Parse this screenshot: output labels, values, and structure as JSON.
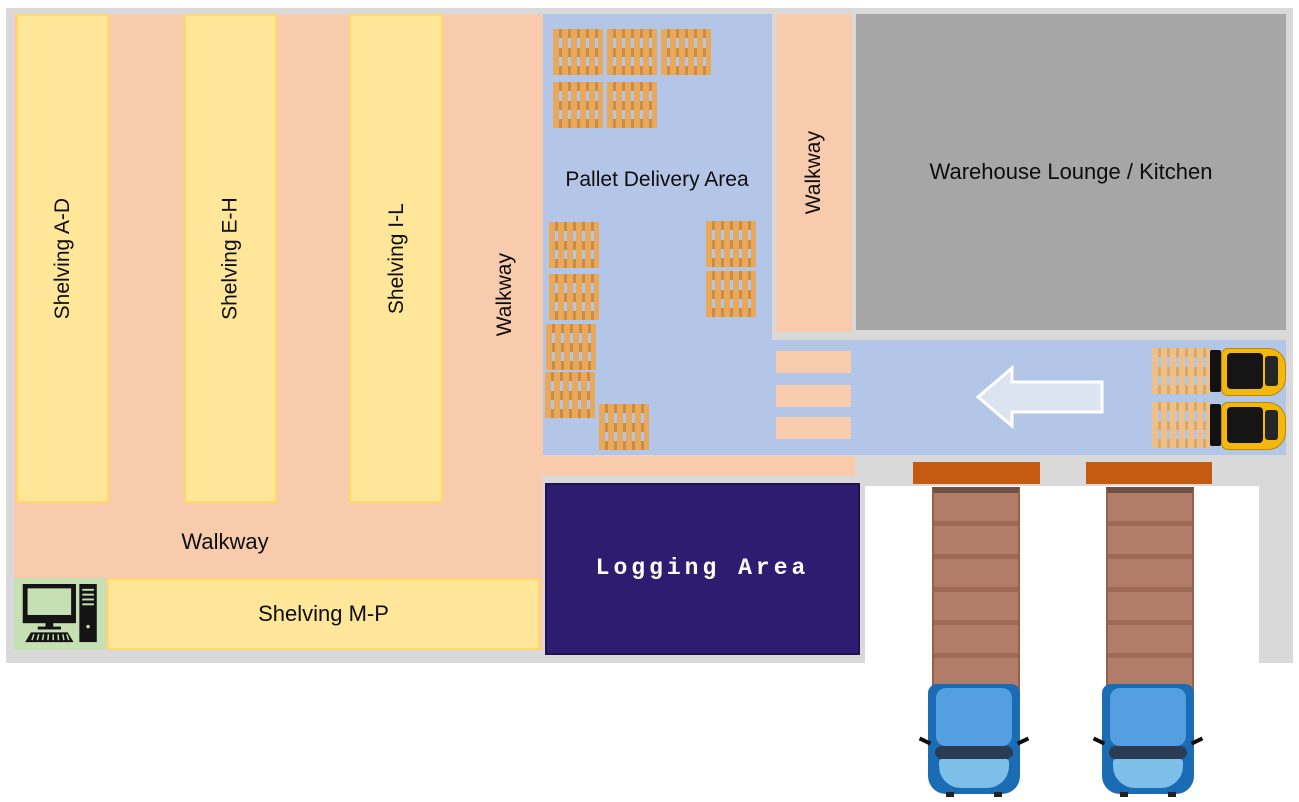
{
  "areas": {
    "shelving_ad": "Shelving A-D",
    "shelving_eh": "Shelving E-H",
    "shelving_il": "Shelving I-L",
    "shelving_mp": "Shelving M-P",
    "walkway_center": "Walkway",
    "walkway_bottom": "Walkway",
    "walkway_right": "Walkway",
    "pallet_delivery": "Pallet Delivery Area",
    "lounge": "Warehouse Lounge / Kitchen",
    "logging": "Logging Area"
  },
  "icons": {
    "pallet": "pallet-icon",
    "forklift": "forklift-icon",
    "truck": "truck-icon",
    "computer": "computer-workstation-icon",
    "flow_arrow": "left-arrow-icon",
    "dock_door": "loading-dock-door",
    "walkway_stripe": "crosswalk-stripe"
  },
  "counts": {
    "delivery_area_pallets": 12,
    "forklifts": 2,
    "forklift_pallets": 2,
    "trucks": 2,
    "loading_docks": 2,
    "crosswalk_stripes": 3
  },
  "colors": {
    "floor": "#d9d9d9",
    "walkway": "#f8cbad",
    "shelving_fill": "#ffe699",
    "shelving_border": "#ffd966",
    "pallet_zone": "#b4c6e7",
    "lounge": "#a6a6a6",
    "logging": "#2e1c70",
    "computer_station": "#c6e0b4",
    "dock_door": "#c55a11",
    "arrow_fill": "#dce4f2",
    "trailer": "#b17d69",
    "cab": "#1a6db4",
    "forklift": "#f3b70d"
  }
}
